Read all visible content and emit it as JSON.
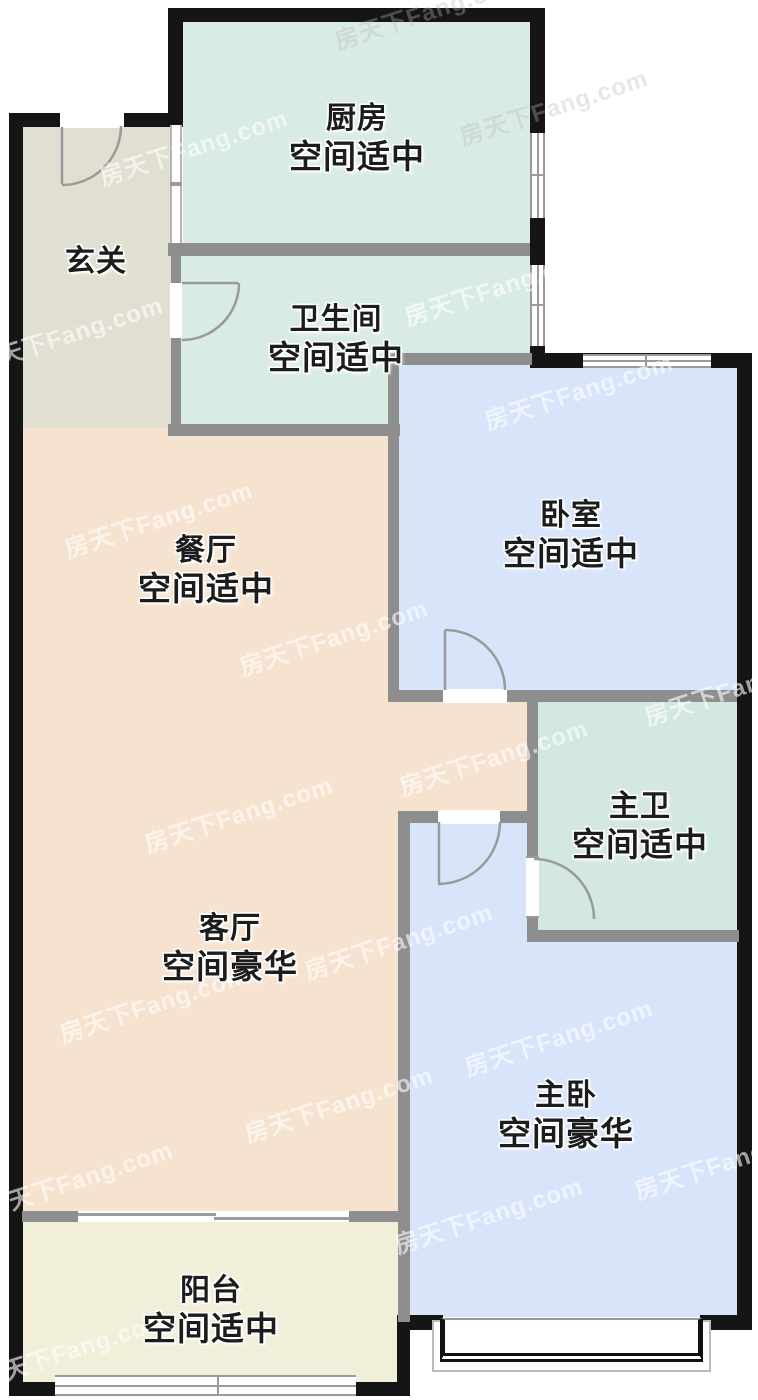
{
  "floorplan": {
    "watermark": "房天下Fang.com",
    "rooms": {
      "hall": {
        "name": "玄关",
        "quality": ""
      },
      "kitchen": {
        "name": "厨房",
        "quality": "空间适中"
      },
      "bath": {
        "name": "卫生间",
        "quality": "空间适中"
      },
      "bedroom": {
        "name": "卧室",
        "quality": "空间适中"
      },
      "dining": {
        "name": "餐厅",
        "quality": "空间适中"
      },
      "master_bath": {
        "name": "主卫",
        "quality": "空间适中"
      },
      "living": {
        "name": "客厅",
        "quality": "空间豪华"
      },
      "master_bedroom": {
        "name": "主卧",
        "quality": "空间豪华"
      },
      "balcony": {
        "name": "阳台",
        "quality": "空间适中"
      }
    },
    "colors": {
      "exterior_wall": "#151515",
      "interior_wall": "#8e8e8e",
      "kitchen_bath_fill": "#d9ece4",
      "master_bath_fill": "#d3e8e0",
      "bedroom_fill": "#d8e4fa",
      "living_dining_fill": "#f6e3cf",
      "hall_fill": "#e1dfd1",
      "balcony_fill": "#f1eeda",
      "door_window_line": "#9a9a9a"
    }
  }
}
